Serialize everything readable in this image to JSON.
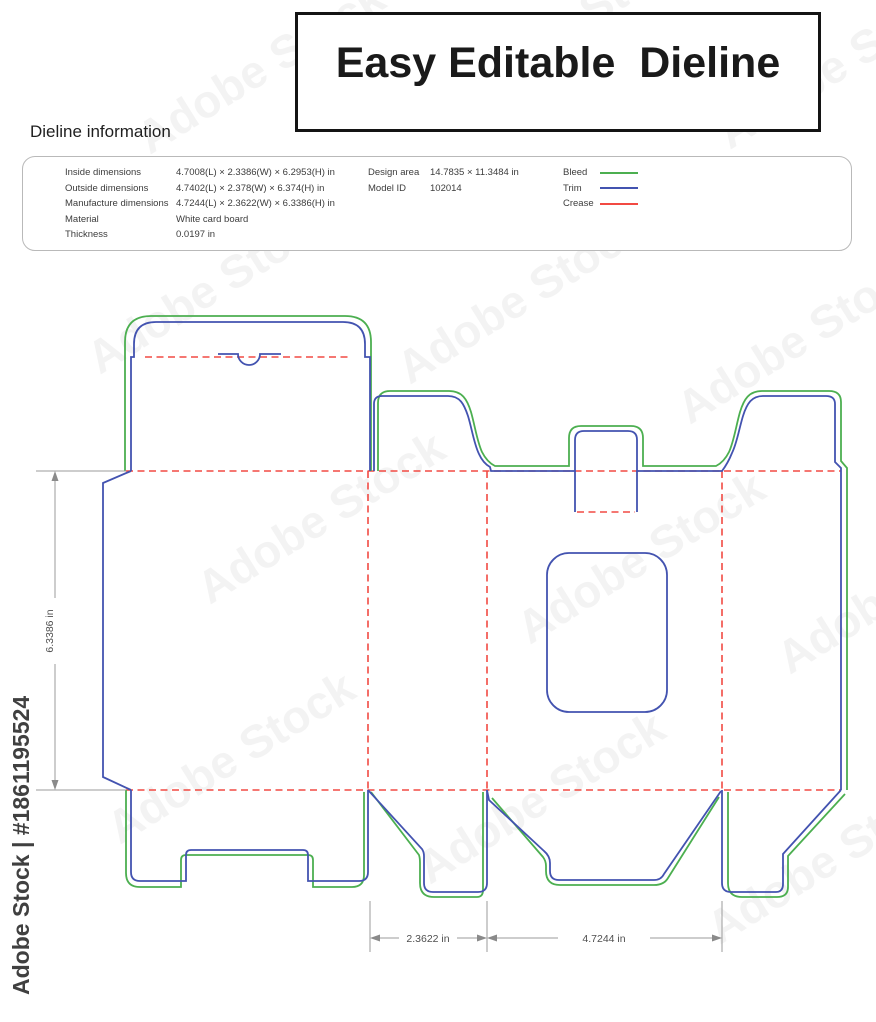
{
  "title": {
    "text": "Easy Editable  Dieline"
  },
  "info": {
    "heading": "Dieline information",
    "rows": [
      {
        "label": "Inside dimensions",
        "value": "4.7008(L) × 2.3386(W) × 6.2953(H) in"
      },
      {
        "label": "Outside dimensions",
        "value": "4.7402(L) × 2.378(W) × 6.374(H) in"
      },
      {
        "label": "Manufacture dimensions",
        "value": "4.7244(L) × 2.3622(W) × 6.3386(H) in"
      },
      {
        "label": "Material",
        "value": "White card board"
      },
      {
        "label": "Thickness",
        "value": "0.0197 in"
      }
    ],
    "design": [
      {
        "label": "Design area",
        "value": "14.7835 × 11.3484 in"
      },
      {
        "label": "Model ID",
        "value": "102014"
      }
    ],
    "legend": [
      {
        "label": "Bleed"
      },
      {
        "label": "Trim"
      },
      {
        "label": "Crease"
      }
    ]
  },
  "dimensions": {
    "height_label": "6.3386 in",
    "side_width_label": "2.3622 in",
    "front_width_label": "4.7244 in"
  },
  "watermark": {
    "tile": "Adobe Stock",
    "vertical": "Adobe Stock | #1861195524"
  },
  "colors": {
    "bleed": "#4caf50",
    "trim": "#4353b0",
    "crease": "#f24a43"
  }
}
